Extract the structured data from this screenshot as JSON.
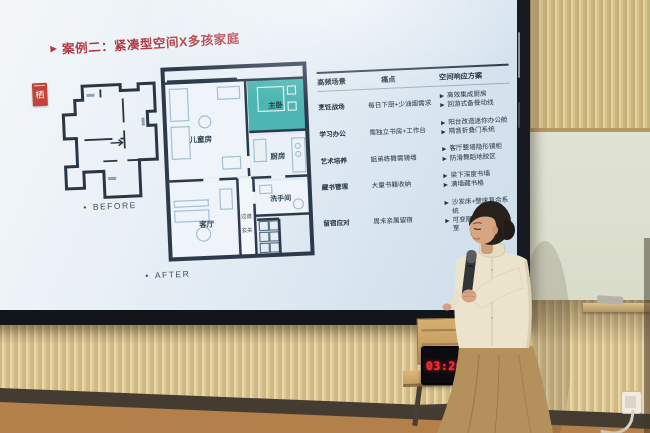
{
  "slide": {
    "header": {
      "line1": "多孩家庭居住空间",
      "line2": "任务一：家庭人物画像"
    },
    "title": "案例二：紧凑型空间X多孩家庭",
    "logo_char": "栖",
    "plans": {
      "before_label": "BEFORE",
      "after_label": "AFTER",
      "rooms": {
        "children": "儿童房",
        "master": "主卧",
        "kitchen": "厨房",
        "living": "客厅",
        "bathroom": "洗手间",
        "hallway": "过道",
        "entry": "玄关"
      }
    },
    "table": {
      "headers": [
        "高频场景",
        "痛点",
        "空间响应方案"
      ],
      "rows": [
        {
          "scene": "烹饪战场",
          "pain": "每日下厨+少油烟需求",
          "solutions": [
            "高效集成厨房",
            "回游式备餐动线"
          ]
        },
        {
          "scene": "学习办公",
          "pain": "需独立书房+工作台",
          "solutions": [
            "阳台改造迷你办公舱",
            "隔音折叠门系统"
          ]
        },
        {
          "scene": "艺术培养",
          "pain": "姐弟练舞需镜墙",
          "solutions": [
            "客厅整墙隐形镜柜",
            "防滑舞蹈地胶区"
          ]
        },
        {
          "scene": "藏书管理",
          "pain": "大量书籍收纳",
          "solutions": [
            "梁下深度书墙",
            "满墙藏书格"
          ]
        },
        {
          "scene": "留宿应对",
          "pain": "周末亲属留宿",
          "solutions": [
            "沙发床+壁床复合系统",
            "可变隔断打造临时卧室"
          ]
        }
      ]
    }
  },
  "clock": {
    "display": "03:20:5"
  },
  "icons": {
    "title_marker": "▶",
    "list_bullet": "•",
    "solution_arrow": "▶"
  },
  "colors": {
    "slide_accent_red": "#b13a42",
    "header_pink": "#c4586a",
    "plan_teal": "#4cb6b2",
    "plan_wall_navy": "#2c3a4c",
    "clock_red": "#ff2b2b",
    "wood_panel": "#d8c28c",
    "wall_sage": "#dcdfcd"
  }
}
